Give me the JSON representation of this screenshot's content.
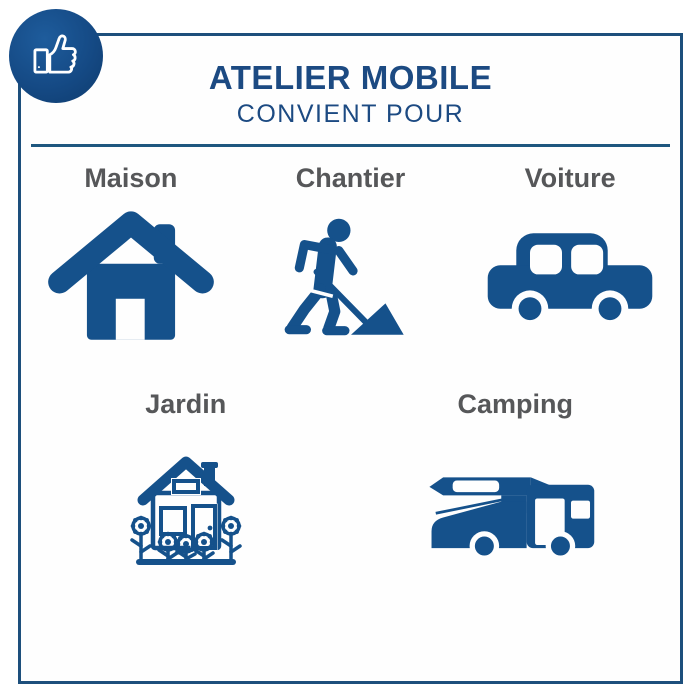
{
  "header": {
    "title": "ATELIER MOBILE",
    "subtitle": "CONVIENT POUR"
  },
  "badge": {
    "icon": "thumbs-up-icon"
  },
  "rows": [
    {
      "items": [
        {
          "label": "Maison",
          "icon": "house-icon"
        },
        {
          "label": "Chantier",
          "icon": "construction-worker-icon"
        },
        {
          "label": "Voiture",
          "icon": "car-icon"
        }
      ]
    },
    {
      "items": [
        {
          "label": "Jardin",
          "icon": "garden-house-flowers-icon"
        },
        {
          "label": "Camping",
          "icon": "camper-van-icon"
        }
      ]
    }
  ],
  "colors": {
    "icon_blue": "#15518b",
    "title_blue": "#1c4a82",
    "label_gray": "#565759",
    "card_border": "#1d4f7c"
  }
}
